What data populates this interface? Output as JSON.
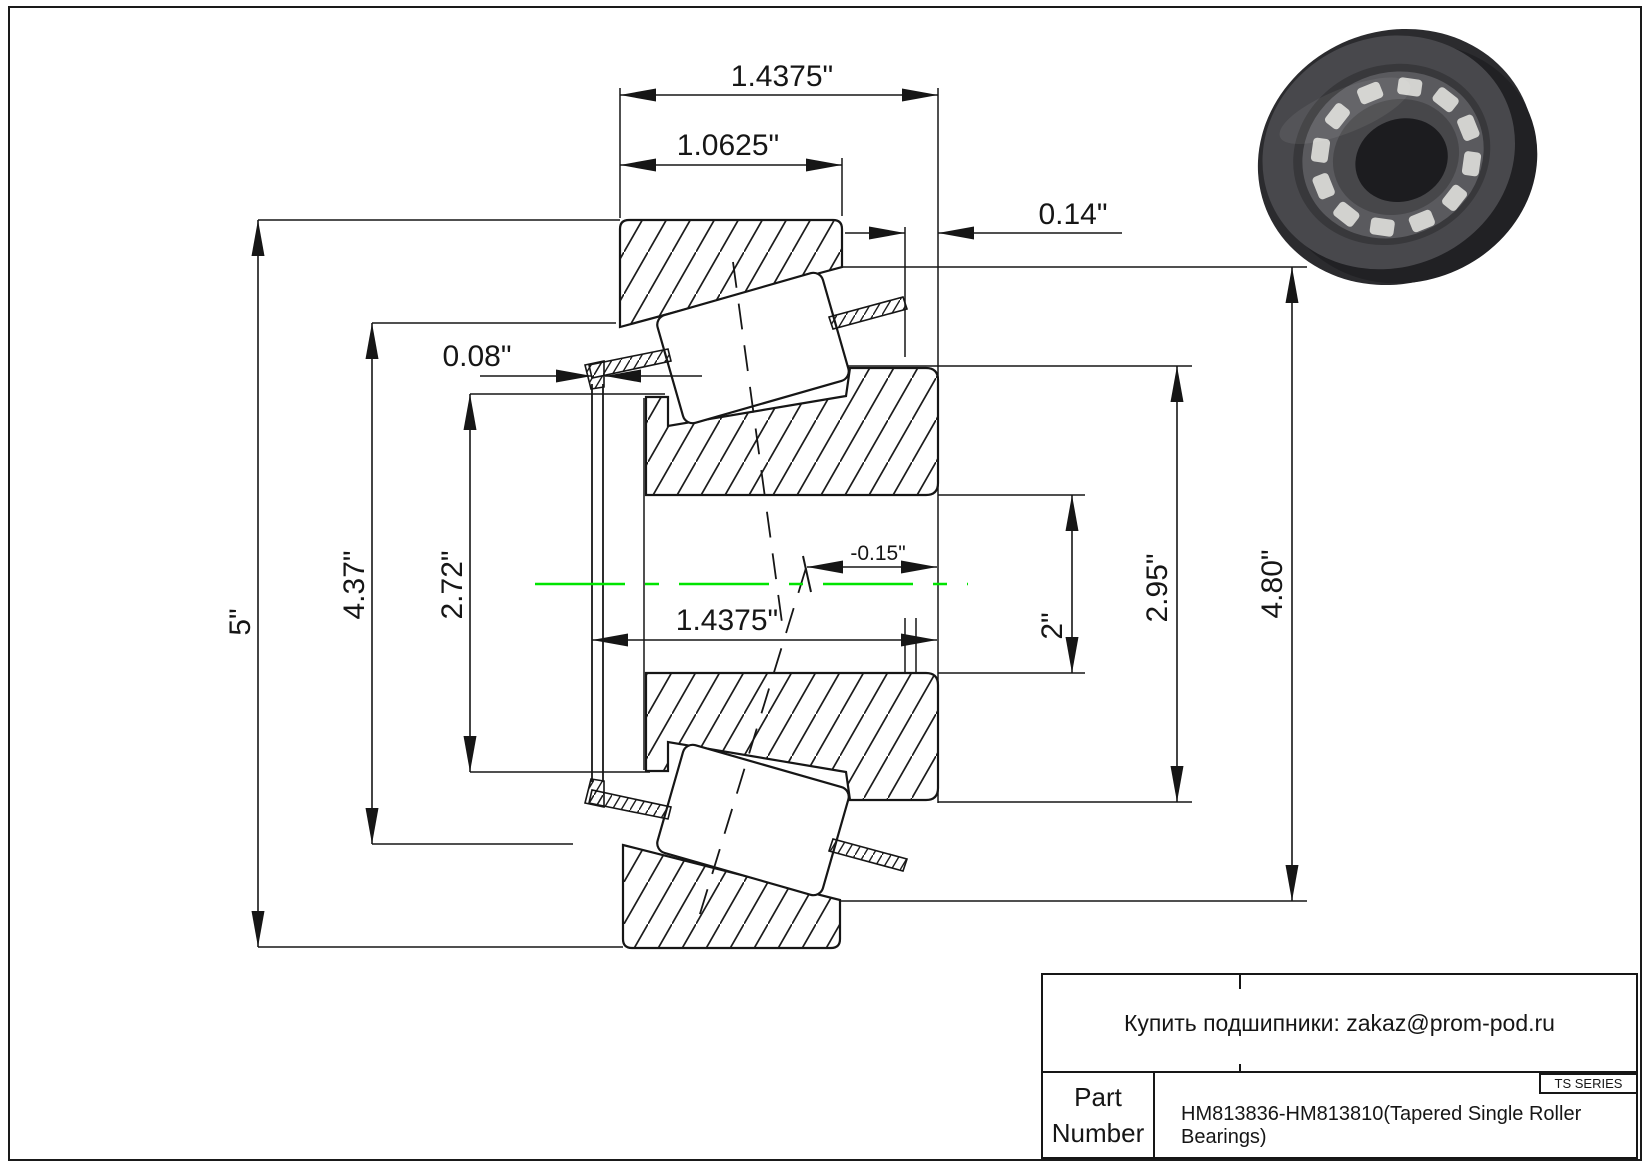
{
  "colors": {
    "line": "#161616",
    "centerline": "#00e400",
    "background": "#ffffff",
    "render_rim": "#2b2b2e",
    "render_face": "#48484c",
    "render_cage": "#5a5a5e",
    "render_roller": "#d2d2cf",
    "render_bore": "#1c1c1f"
  },
  "dimensions": {
    "total_width_top": "1.4375\"",
    "cup_width": "1.0625\"",
    "cage_protrusion": "0.14\"",
    "cage_front_gap": "0.08\"",
    "outer_diameter": "5\"",
    "shoulder_diameter": "4.37\"",
    "rib_diameter": "2.72\"",
    "total_width_bottom": "1.4375\"",
    "effective_center_offset": "-0.15\"",
    "bore_diameter": "2\"",
    "cone_backface_diameter": "2.95\"",
    "housing_diameter": "4.80\""
  },
  "title_block": {
    "contact": "Купить подшипники: zakaz@prom-pod.ru",
    "series": "TS SERIES",
    "part_label_line1": "Part",
    "part_label_line2": "Number",
    "part_number": "HM813836-HM813810(Tapered Single Roller Bearings)"
  }
}
